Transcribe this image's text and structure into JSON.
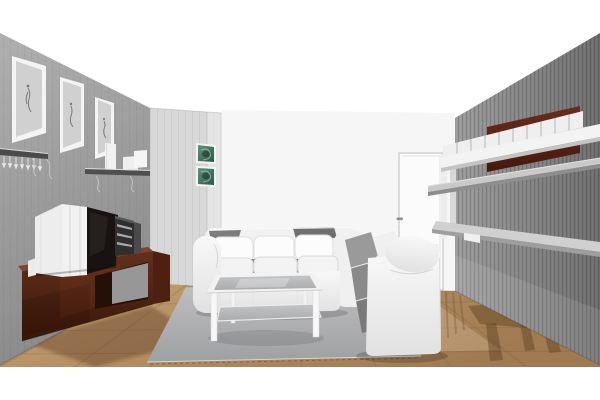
{
  "scene": {
    "type": "3d-interior-render",
    "room": "living-room",
    "view": "one-point perspective toward back wall, white render background"
  },
  "objects": [
    "framed-sketch-art (3, left wall)",
    "wall-shelf with hanging stemware",
    "wall-shelf with vase and boxes",
    "crt-tv on mahogany media console",
    "stereo-unit",
    "green-art-prints (2, alcove wall)",
    "door with handle (back wall)",
    "mahogany wall niche with white storage boxes",
    "gray wall shelves (right wall)",
    "white three-seat sofa",
    "white coffee table with glass top",
    "two-seat sofa with gray cushions",
    "gray area rug",
    "wooden plank floor with shadows"
  ],
  "colors": {
    "background": "#ffffff",
    "left_wall_top": "#b0b0b0",
    "left_wall_bottom": "#8a8a8a",
    "alcove_wall": "#d8d8d8",
    "back_wall": "#f6f6f6",
    "right_wall_near": "#9b9b9b",
    "right_wall_far": "#6d6d6d",
    "niche_top": "#6b2d1b",
    "niche_bottom": "#45190d",
    "floor_light": "#c6a273",
    "floor_dark": "#a07a50",
    "rug_light": "#bebebf",
    "rug_dark": "#9fa0a2",
    "console_top": "#63301c",
    "console_bottom": "#3a1608",
    "console_side": "#4d2012",
    "sofa_white": "#f8f8f8",
    "sofa_shadow": "#e1e1e1",
    "cushion_gray_back": "#9a9a9a",
    "cushion_gray_mid": "#8a8a8a",
    "cushion_gray_seat": "#7a7a7a",
    "glass_top": "#c4c5c7",
    "glass_bottom": "#aaabad",
    "tv_screen": "#181310",
    "tv_cabinet": "#ededed",
    "stereo_body": "#2f2f2f",
    "shelf_gray": "#c9c9c9",
    "shelf_gray_dark": "#9e9e9e",
    "box_white": "#efefef",
    "door_face": "#fbfbfb",
    "door_edge": "#bdbdbd",
    "art_green_light": "#5d947c",
    "art_green_dark": "#2c5947",
    "frame_white": "#f4f4f4",
    "mat_gray": "#d0d0d0"
  }
}
